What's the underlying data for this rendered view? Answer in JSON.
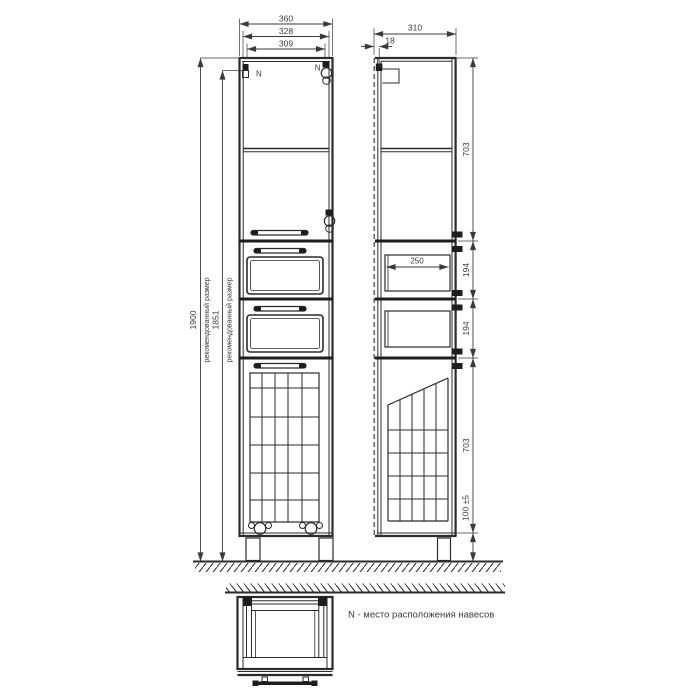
{
  "dims": {
    "front": {
      "overall_width": "360",
      "door_width": "328",
      "inner_width": "309",
      "overall_height": "1900",
      "overall_height_note": "рекомендованный размер",
      "body_height": "1851",
      "body_height_note": "рекомендованный размер"
    },
    "side": {
      "depth": "310",
      "door_thickness": "18",
      "upper_section": "703",
      "drawer_section_a": "194",
      "drawer_section_b": "194",
      "lower_section": "703",
      "plinth_height": "100 ±5",
      "drawer_depth": "250"
    }
  },
  "labels": {
    "hinge_left": "N",
    "hinge_right": "N",
    "note": "N - место расположения навесов"
  },
  "colors": {
    "line": "#2b2b2b",
    "text": "#3a3a3a",
    "background": "#ffffff"
  }
}
